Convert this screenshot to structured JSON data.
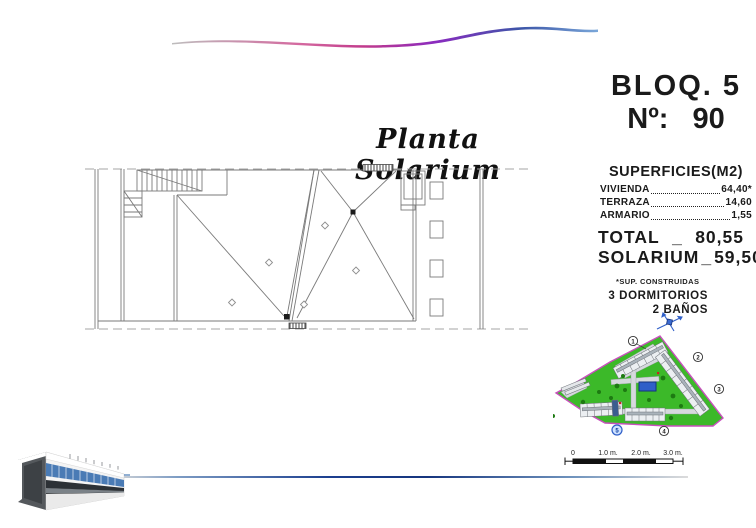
{
  "page": {
    "title_script": "Planta Solarium"
  },
  "header": {
    "block": "BLOQ. 5",
    "number_label": "Nº:",
    "number_value": "90"
  },
  "superficies": {
    "title": "SUPERFICIES(M2)",
    "rows": [
      {
        "label": "VIVIENDA",
        "value": "64,40*"
      },
      {
        "label": "TERRAZA",
        "value": "14,60"
      },
      {
        "label": "ARMARIO",
        "value": "1,55"
      }
    ],
    "total": {
      "label": "TOTAL",
      "sep": "_",
      "value": "80,55"
    },
    "solarium": {
      "label": "SOLARIUM",
      "sep": "_",
      "value": "59,50"
    },
    "footnote": "*SUP. CONSTRUIDAS",
    "bedrooms": "3 DORMITORIOS",
    "bathrooms": "2 BAÑOS"
  },
  "site_plan": {
    "blocks": [
      "1",
      "2",
      "3",
      "4",
      "5"
    ],
    "highlighted_block": "5"
  },
  "scale_bar": {
    "ticks": [
      "0",
      "1.0 m.",
      "2.0 m.",
      "3.0 m."
    ]
  },
  "colors": {
    "site_green": "#3CB929",
    "site_border": "#C94FBE",
    "pool_blue": "#2F5FC8",
    "ribbon_magenta": "#C13A8C",
    "ribbon_purple": "#8A2BBF",
    "ribbon_blue": "#3C56A8"
  }
}
